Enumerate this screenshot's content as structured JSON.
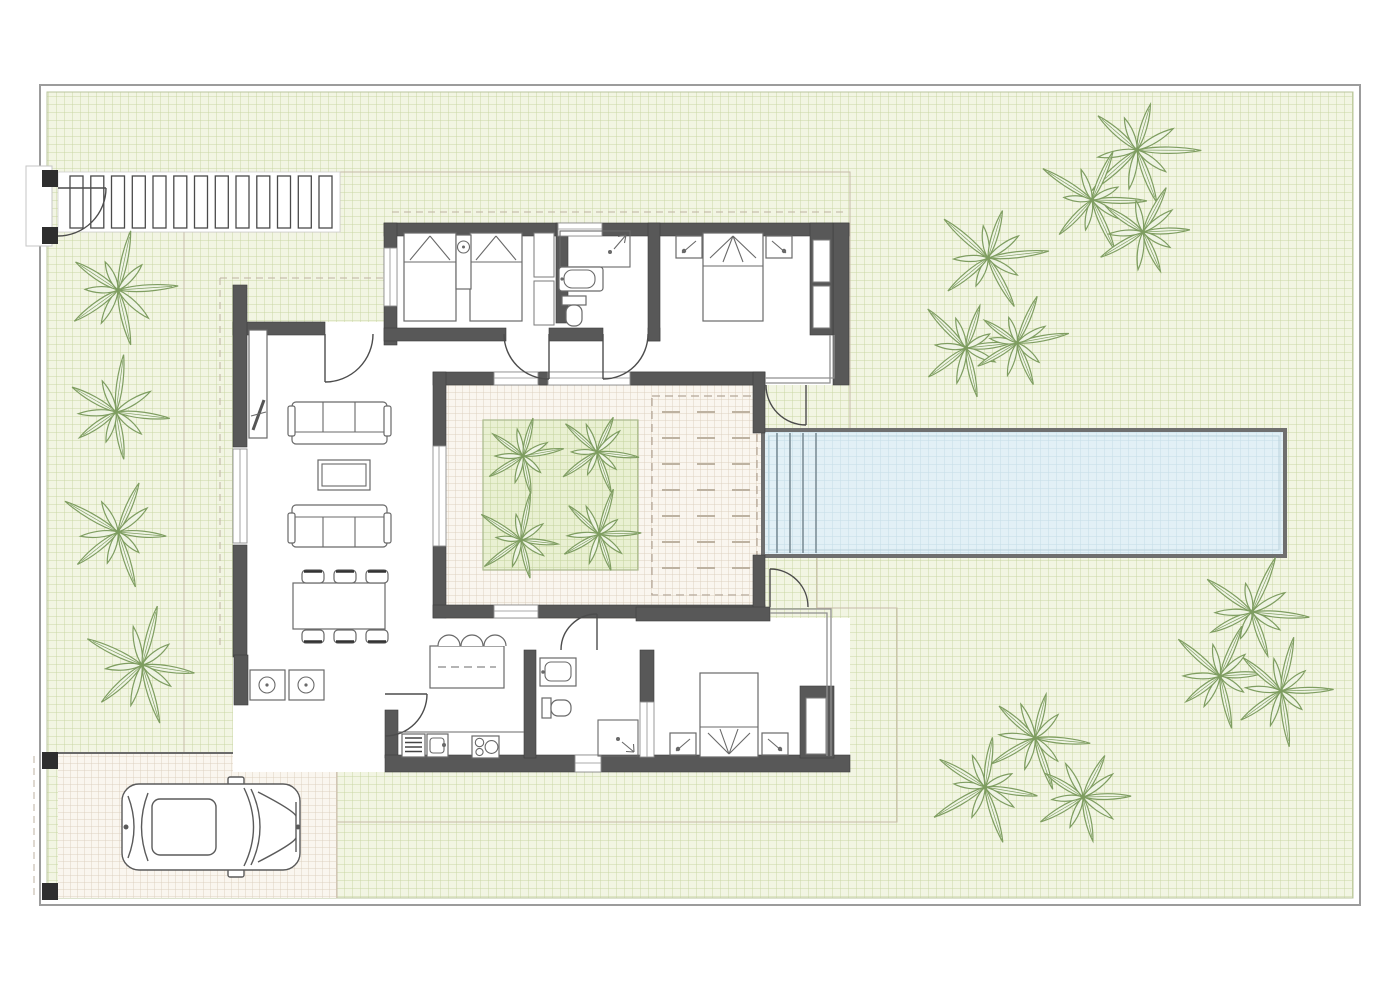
{
  "document": {
    "type": "architectural-floor-plan",
    "label": "villa-site-plan-with-garden-and-pool"
  },
  "palette": {
    "boundary": "#9c9c9c",
    "grass_fill": "#f2f5e3",
    "grass_line": "#c9d7a5",
    "terrace_fill": "#faf6ef",
    "terrace_line": "#ddd1c1",
    "terrace_edge": "#c7baa8",
    "planter_fill": "#e9f0d2",
    "planter_line": "#c2d29c",
    "pool_fill": "#e2f0f6",
    "pool_line": "#c4dde7",
    "pool_border": "#6f6f6f",
    "wall": "#585858",
    "wall_edge": "#3d3d3d",
    "furniture": "#696969",
    "door": "#4c4c4c",
    "glass": "#8f8f8f",
    "dash": "#bdb2a1",
    "gate_post": "#2e2e2e",
    "palm_stroke": "#7e9d60",
    "palm_fill": "#eff4e4"
  },
  "site": {
    "boundary": {
      "x": 40,
      "y": 85,
      "w": 1320,
      "h": 820
    },
    "pergola_walkway": {
      "x": 58,
      "y": 172,
      "w": 282,
      "h": 60,
      "slat_count": 13,
      "slat_w": 13
    },
    "pool": {
      "x": 763,
      "y": 430,
      "w": 522,
      "h": 126,
      "steps": 4,
      "step_gap": 13
    },
    "sun_deck": {
      "x": 652,
      "y": 396,
      "w": 105,
      "h": 199,
      "dash_rows": 7,
      "dash_cols": 3
    },
    "planter": {
      "x": 483,
      "y": 420,
      "w": 155,
      "h": 150
    },
    "driveway": {
      "x": 58,
      "y": 753,
      "w": 279,
      "h": 145
    },
    "garden_palms": [
      [
        118,
        290,
        1.05
      ],
      [
        116,
        412,
        1.0
      ],
      [
        118,
        532,
        1.0
      ],
      [
        142,
        665,
        1.05
      ],
      [
        1137,
        150,
        1.05
      ],
      [
        1092,
        200,
        0.95
      ],
      [
        1143,
        232,
        0.95
      ],
      [
        988,
        258,
        1.0
      ],
      [
        966,
        348,
        0.95
      ],
      [
        1017,
        343,
        0.9
      ],
      [
        1252,
        612,
        1.0
      ],
      [
        1220,
        676,
        0.95
      ],
      [
        1281,
        691,
        0.95
      ],
      [
        1035,
        738,
        0.95
      ],
      [
        985,
        787,
        1.0
      ],
      [
        1083,
        797,
        0.95
      ]
    ],
    "courtyard_palms": [
      [
        523,
        456,
        0.8
      ],
      [
        597,
        452,
        0.8
      ],
      [
        521,
        540,
        0.8
      ],
      [
        599,
        534,
        0.8
      ]
    ]
  },
  "inventory": {
    "bedrooms": 3,
    "bathrooms": 2,
    "twin_beds": 2,
    "double_beds": 2,
    "sofas": 2,
    "dining_chairs": 6,
    "island_stools": 3,
    "cars": 1,
    "palm_trees_total": 20
  },
  "kitchen": {
    "dishwasher_stripes": 4,
    "hob_burners": 3
  },
  "dining": {
    "chairs_top": 3,
    "chairs_bottom": 3,
    "chair_xs": [
      302,
      334,
      366
    ]
  }
}
